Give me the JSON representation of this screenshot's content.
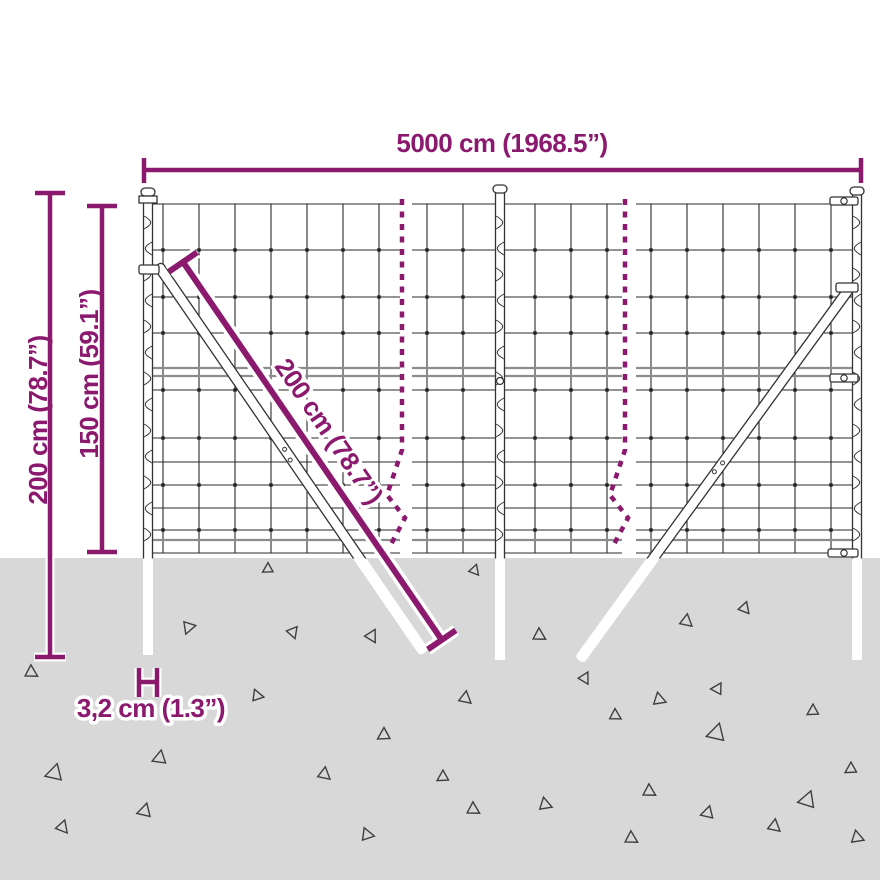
{
  "title": "Wire mesh fence dimension diagram",
  "colors": {
    "accent": "#8b1a6f",
    "ground": "#d8d8d8",
    "wire": "#2a2a2a"
  },
  "dimensions": {
    "width_label": "5000 cm (1968.5”)",
    "total_height_label": "200 cm (78.7”)",
    "above_ground_height_label": "150 cm (59.1”)",
    "brace_length_label": "200 cm (78.7”)",
    "post_thickness_label": "3,2 cm (1.3”)"
  },
  "decor": {
    "triangles": [
      [
        268,
        568,
        10,
        0
      ],
      [
        475,
        571,
        10,
        140
      ],
      [
        188,
        628,
        12,
        200
      ],
      [
        293,
        633,
        11,
        160
      ],
      [
        372,
        637,
        12,
        150
      ],
      [
        540,
        636,
        12,
        120
      ],
      [
        687,
        622,
        12,
        130
      ],
      [
        745,
        609,
        11,
        140
      ],
      [
        32,
        673,
        12,
        120
      ],
      [
        258,
        696,
        11,
        100
      ],
      [
        466,
        699,
        12,
        130
      ],
      [
        660,
        700,
        12,
        110
      ],
      [
        718,
        688,
        11,
        30
      ],
      [
        616,
        716,
        11,
        120
      ],
      [
        717,
        732,
        17,
        15
      ],
      [
        813,
        710,
        11,
        0
      ],
      [
        585,
        679,
        11,
        150
      ],
      [
        160,
        757,
        13,
        10
      ],
      [
        55,
        772,
        16,
        15
      ],
      [
        384,
        734,
        12,
        0
      ],
      [
        325,
        775,
        12,
        130
      ],
      [
        443,
        776,
        11,
        0
      ],
      [
        474,
        810,
        12,
        120
      ],
      [
        546,
        805,
        12,
        110
      ],
      [
        851,
        768,
        11,
        0
      ],
      [
        808,
        799,
        16,
        20
      ],
      [
        650,
        792,
        12,
        120
      ],
      [
        145,
        810,
        13,
        15
      ],
      [
        63,
        828,
        12,
        140
      ],
      [
        368,
        835,
        12,
        100
      ],
      [
        708,
        812,
        12,
        15
      ],
      [
        775,
        827,
        12,
        130
      ],
      [
        632,
        839,
        12,
        120
      ],
      [
        858,
        838,
        12,
        110
      ]
    ]
  }
}
